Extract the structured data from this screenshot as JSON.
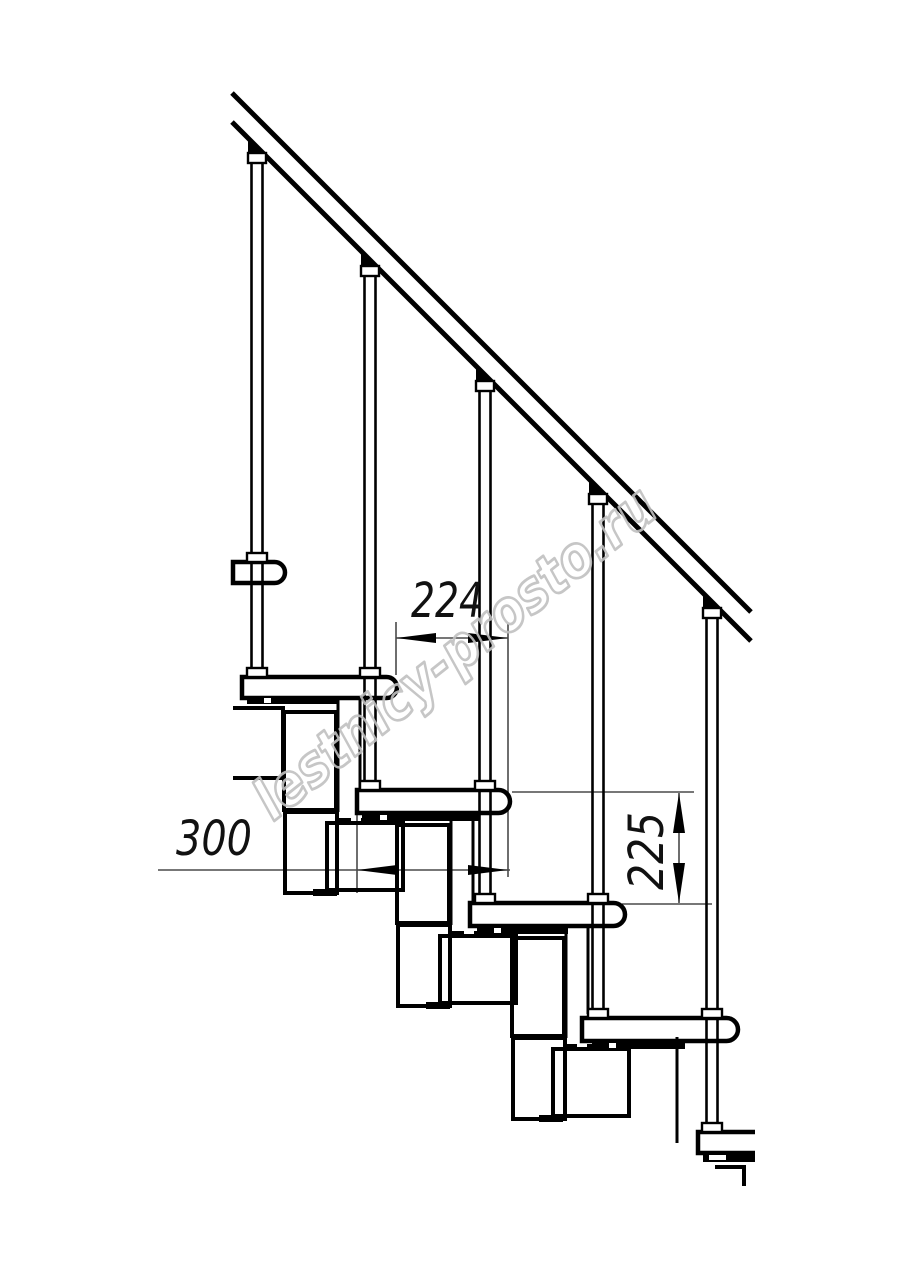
{
  "drawing": {
    "kind": "modular-staircase-side-view-technical-drawing",
    "background": "#ffffff",
    "line_color": "#000000",
    "dimension_line_color": "#4a4a4a"
  },
  "dimensions": {
    "run": {
      "label": "224",
      "orientation": "horizontal"
    },
    "tread_depth": {
      "label": "300",
      "orientation": "horizontal"
    },
    "rise": {
      "label": "225",
      "orientation": "vertical"
    }
  },
  "watermark": {
    "text": "lestnicy-prosto.ru",
    "color": "#c0c0c0"
  }
}
